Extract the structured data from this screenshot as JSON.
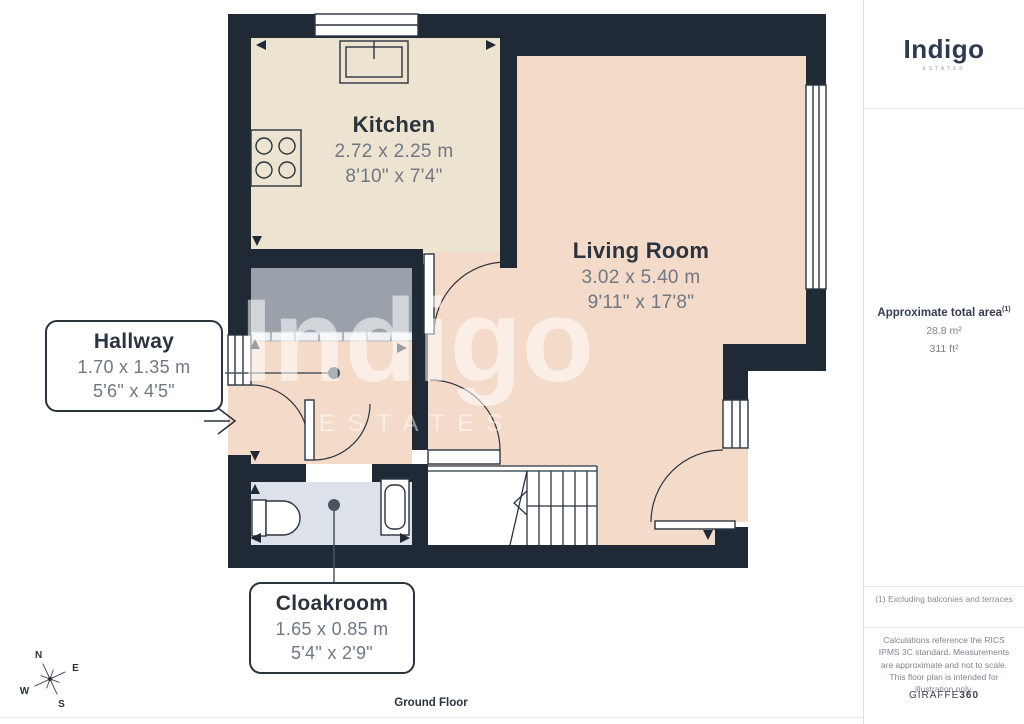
{
  "floorplan": {
    "watermark": {
      "word": "Indigo",
      "sub": "ESTATES"
    },
    "floor_label": "Ground Floor",
    "rooms": [
      {
        "name": "Kitchen",
        "metric": "2.72 x 2.25 m",
        "imperial": "8'10\" x 7'4\""
      },
      {
        "name": "Living Room",
        "metric": "3.02 x 5.40 m",
        "imperial": "9'11\" x 17'8\""
      },
      {
        "name": "Hallway",
        "metric": "1.70 x 1.35 m",
        "imperial": "5'6\" x 4'5\""
      },
      {
        "name": "Cloakroom",
        "metric": "1.65 x 0.85 m",
        "imperial": "5'4\" x 2'9\""
      }
    ],
    "compass": {
      "north": "N",
      "east": "E",
      "south": "S",
      "west": "W"
    }
  },
  "sidebar": {
    "logo": {
      "name": "Indigo",
      "sub": "ESTATES"
    },
    "area": {
      "title": "Approximate total area",
      "note_ref": "(1)",
      "metric": "28.8 m²",
      "imperial": "311 ft²"
    },
    "footnote": "(1) Excluding balconies and terraces",
    "disclaimer": "Calculations reference the RICS IPMS 3C standard. Measurements are approximate and not to scale. This floor plan is intended for illustration only.",
    "brand": {
      "name": "GIRAFFE",
      "suffix": "360"
    }
  },
  "colors": {
    "wall": "#202a36",
    "kitchen": "#ece3d0",
    "living": "#f3dac9",
    "cloak": "#dde1ea",
    "closet": "#9aa1ab",
    "closet-dark": "#8a919b",
    "rail": "#eef0f2",
    "ink": "#2a333e",
    "dim": "#6f7883",
    "outline": "#2b3440",
    "leader": "#4a5460",
    "navy": "#2e3a50"
  }
}
